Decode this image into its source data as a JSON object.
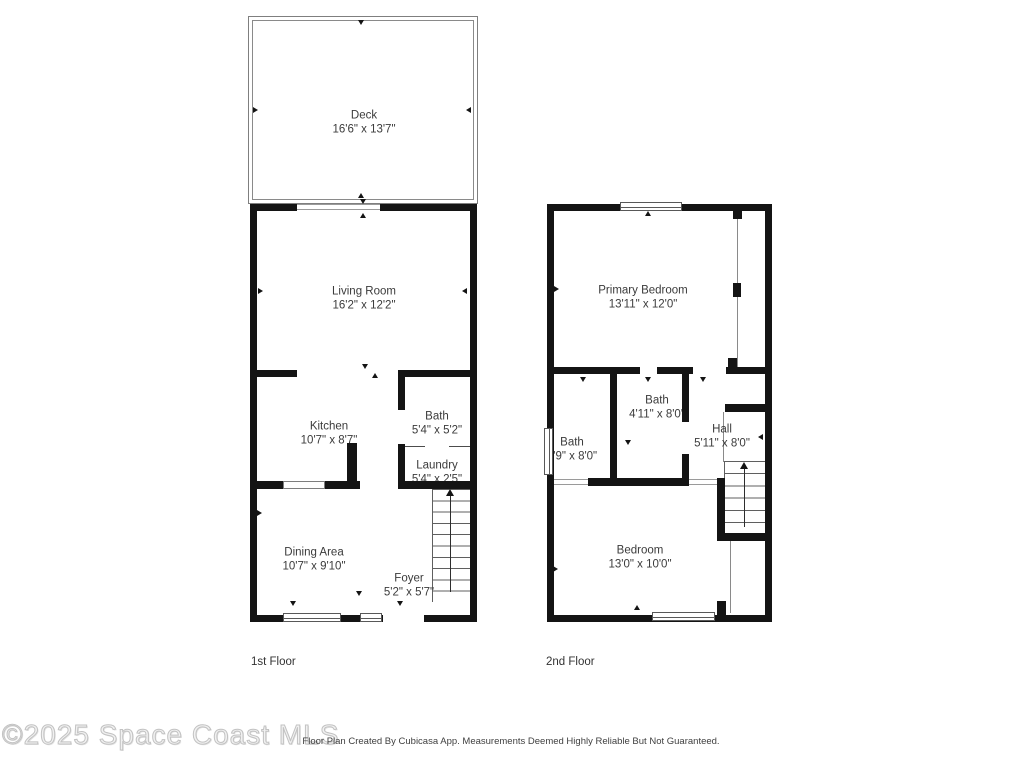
{
  "floors": [
    {
      "label": "1st Floor",
      "rooms": [
        {
          "name": "Deck",
          "dims": "16'6\" x 13'7\""
        },
        {
          "name": "Living Room",
          "dims": "16'2\" x 12'2\""
        },
        {
          "name": "Kitchen",
          "dims": "10'7\" x 8'7\""
        },
        {
          "name": "Bath",
          "dims": "5'4\" x 5'2\""
        },
        {
          "name": "Laundry",
          "dims": "5'4\" x 2'5\""
        },
        {
          "name": "Dining Area",
          "dims": "10'7\" x 9'10\""
        },
        {
          "name": "Foyer",
          "dims": "5'2\" x 5'7\""
        }
      ]
    },
    {
      "label": "2nd Floor",
      "rooms": [
        {
          "name": "Primary Bedroom",
          "dims": "13'11\" x 12'0\""
        },
        {
          "name": "Bath",
          "dims": "4'11\" x 8'0\""
        },
        {
          "name": "Bath",
          "dims": "4'9\" x 8'0\""
        },
        {
          "name": "Hall",
          "dims": "5'11\" x 8'0\""
        },
        {
          "name": "Bedroom",
          "dims": "13'0\" x 10'0\""
        }
      ]
    }
  ],
  "watermark": "©2025 Space Coast MLS",
  "footer": "Floor Plan Created By Cubicasa App. Measurements Deemed Highly Reliable But Not Guaranteed.",
  "icons": {
    "stairs_direction": "up-arrow"
  },
  "colors": {
    "wall": "#141414",
    "thin_wall": "#8a8a8a",
    "label_text": "#3b3b3b",
    "watermark": "#d9d9d9",
    "footer_text": "#3f3f3f"
  }
}
